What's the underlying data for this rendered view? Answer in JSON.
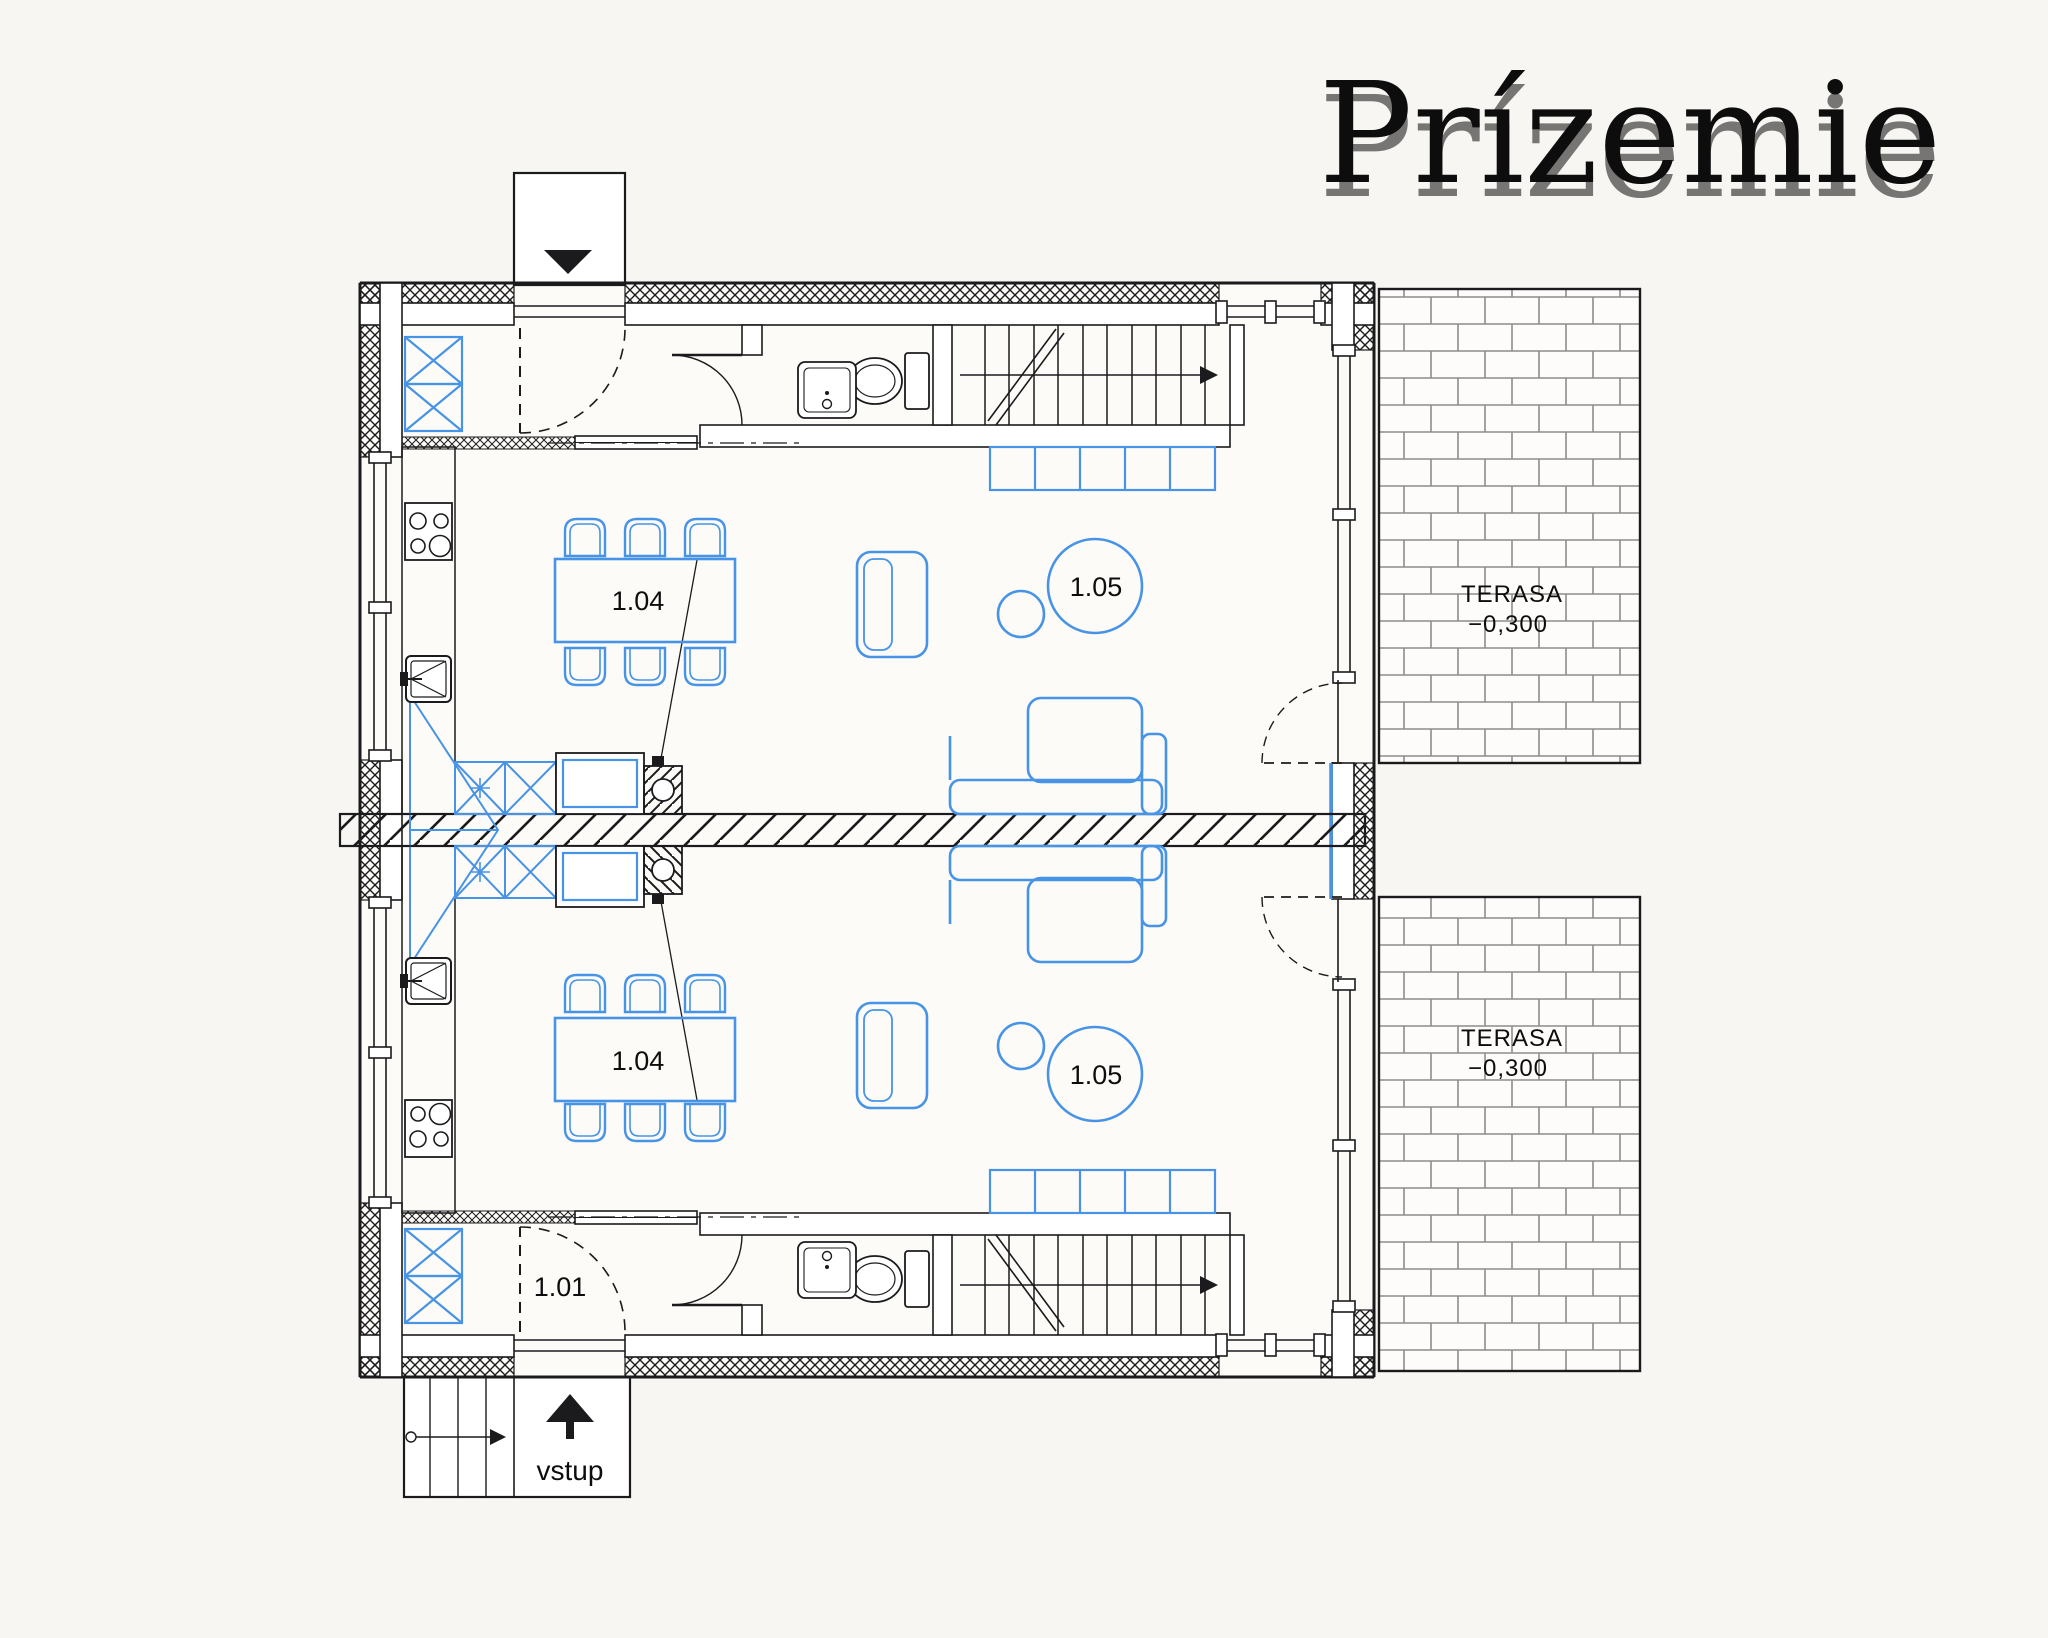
{
  "page": {
    "background": "#f7f6f2"
  },
  "title": {
    "text": "Prízemie",
    "color": "#101010",
    "ghost_color": "#a9a7a2"
  },
  "plan": {
    "ink": "#1b1b1d",
    "furniture_color": "#4793e6",
    "units": [
      {
        "id": "A",
        "dining_room_label": "1.04",
        "living_room_label": "1.05"
      },
      {
        "id": "B",
        "dining_room_label": "1.04",
        "living_room_label": "1.05",
        "entry_hall_label": "1.01"
      }
    ],
    "terraces": [
      {
        "position": "top",
        "name": "TERASA",
        "level": "−0,300"
      },
      {
        "position": "bottom",
        "name": "TERASA",
        "level": "−0,300"
      }
    ],
    "entrance": {
      "label": "vstup"
    },
    "icons": [
      "exit-triangle-icon",
      "entrance-arrow-icon",
      "stairs-direction-arrow-icon",
      "cooktop-icon",
      "kitchen-sink-icon",
      "toilet-icon",
      "washbasin-icon",
      "wardrobe-cross-icon",
      "flue-detail-icon"
    ]
  }
}
